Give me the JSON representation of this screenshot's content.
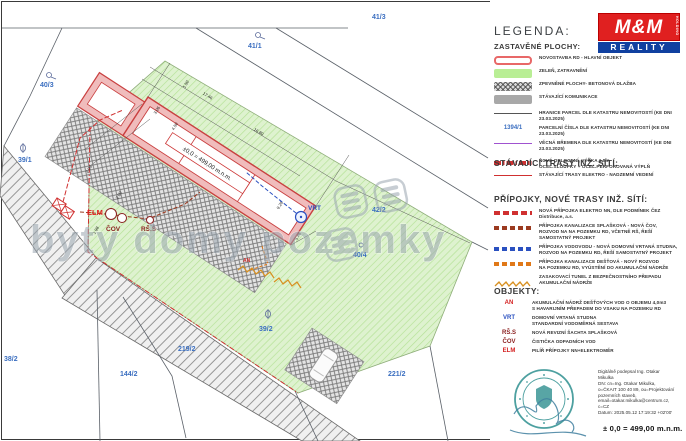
{
  "colors": {
    "red": "#d03030",
    "green_fill": "#ddf2cc",
    "blue": "#3a6ec0",
    "purple": "#a052d0",
    "orange": "#e07818",
    "maroon": "#8b2020",
    "teal": "#2e8f8f",
    "logo_red": "#e02020",
    "logo_blue": "#1040a0"
  },
  "plan": {
    "watermark": "byty domy pozemky",
    "building_label": "±0,0 = 499,00 m.n.m.",
    "parcels": [
      "40/3",
      "41/1",
      "41/3",
      "39/1",
      "38/2",
      "144/2",
      "219/2",
      "39/2",
      "221/2",
      "42/2",
      "40/4"
    ],
    "points": {
      "vrt": "VRT",
      "elm": "ELM",
      "cov": "ČOV",
      "rss": "RŠ.S",
      "an": "AN"
    },
    "dimensions": [
      "17.46",
      "16.80",
      "9.26",
      "5.46",
      "4.50",
      "3.06",
      "2.06",
      "1.50",
      "1.98",
      "2.00"
    ]
  },
  "legend": {
    "title": "LEGENDA:",
    "logo": {
      "mm": "M&M",
      "reality": "REALITY",
      "holding": "HOLDING"
    },
    "s1": {
      "heading": "ZASTAVĚNÉ PLOCHY:",
      "items": [
        {
          "l1": "NOVOSTAVBA RD - HLAVNÍ OBJEKT",
          "l2": ""
        },
        {
          "l1": "ZELEŇ, ZATRAVNĚNÍ",
          "l2": ""
        },
        {
          "l1": "ZPEVNĚNÉ PLOCHY- BETONOVÁ DLAŽBA",
          "l2": ""
        },
        {
          "l1": "STÁVAJÍCÍ KOMUNIKACE",
          "l2": ""
        },
        {
          "l1": "HRANICE PARCEL DLE KATASTRU NEMOVITOSTÍ (KE DNI 23.03.2025)",
          "l2": ""
        },
        {
          "sample": "1394/1",
          "l1": "PARCELNÍ ČÍSLA DLE KATASTRU NEMOVITOSTÍ (KE DNI 23.03.2025)",
          "l2": ""
        },
        {
          "l1": "VĚCNÁ BŘEMENA DLE KATASTRU NEMOVITOSTÍ (KE DNI 23.03.2025)",
          "l2": ""
        },
        {
          "l1": "NOVÉ OPLOCENÍ, VÝŠKA 1,5m",
          "l2": "OCEL.SLOUPKY + OCEL.PERFOROVANÁ VÝPLŇ"
        }
      ]
    },
    "s2": {
      "heading": "STÁVAJÍCÍ TRASY INŽ. SÍTÍ:",
      "items": [
        {
          "l1": "STÁVAJÍCÍ TRASY ELEKTRO - NADZEMNÍ VEDENÍ",
          "l2": ""
        }
      ]
    },
    "s3": {
      "heading": "PŘÍPOJKY, NOVÉ TRASY INŽ. SÍTÍ:",
      "items": [
        {
          "l1": "NOVÁ PŘÍPOJKA ELEKTRO NN, DLE PODMÍNEK ČEZ Distribuce, a.s.",
          "l2": ""
        },
        {
          "l1": "PŘÍPOJKA KANALIZACE SPLAŠKOVÁ - NOVÁ ČOV,",
          "l2": "ROZVOD NA NA POZEMKU RD, VČETNĚ RŠ, ŘEŠÍ SAMOSTATNÝ PROJEKT"
        },
        {
          "l1": "PŘÍPOJKA VODOVODU - NOVÁ DOMOVNÍ VRTANÁ STUDNA,",
          "l2": "ROZVOD NA POZEMKU RD, ŘEŠÍ SAMOSTATNÝ PROJEKT"
        },
        {
          "l1": "PŘÍPOJKA KANALIZACE DEŠŤOVÁ - NOVÝ ROZVOD",
          "l2": "NA POZEMKU RD, VYÚSTĚNÍ DO AKUMULAČNÍ NÁDRŽE"
        },
        {
          "l1": "ZASAKOVACÍ TUNEL Z BEZPEČNOSTNÍHO PŘEPADU AKUMULAČNÍ NÁDRŽE",
          "l2": ""
        }
      ]
    },
    "s4": {
      "heading": "OBJEKTY:",
      "items": [
        {
          "key": "AN",
          "l1": "AKUMULAČNÍ NÁDRŽ DEŠŤOVÝCH VOD O OBJEMU 4,0m3",
          "l2": "S HAVARIJNÍM PŘEPADEM DO VSAKU NA POZEMKU RD"
        },
        {
          "key": "VRT",
          "l1": "DOMOVNÍ VRTANÁ STUDNA",
          "l2": "STANDARDNÍ VODOMĚRNÁ SESTAVA"
        },
        {
          "key": "RŠ.S",
          "l1": "NOVÁ REVIZNÍ ŠACHTA SPLAŠKOVÁ",
          "l2": ""
        },
        {
          "key": "ČOV",
          "l1": "ČISTIČKA ODPADNÍCH VOD",
          "l2": ""
        },
        {
          "key": "ELM",
          "l1": "PILÍŘ PŘÍPOJKY NN+ELEKTROMĚR",
          "l2": ""
        }
      ]
    }
  },
  "sign": {
    "lines": [
      "Digitálně podepsal Ing. Otakar",
      "Mikulka",
      "DN: cn=Ing. Otakar Mikulka,",
      "o=ČKAIT 100 40 89, ou=Projektování",
      "pozemních staveb,",
      "email=otakar.mikulka@centrum.cz,",
      "c=CZ",
      "Datum: 2025.05.12 17:19:32 +02'00'"
    ],
    "level": "± 0,0 = 499,00 m.n.m."
  }
}
